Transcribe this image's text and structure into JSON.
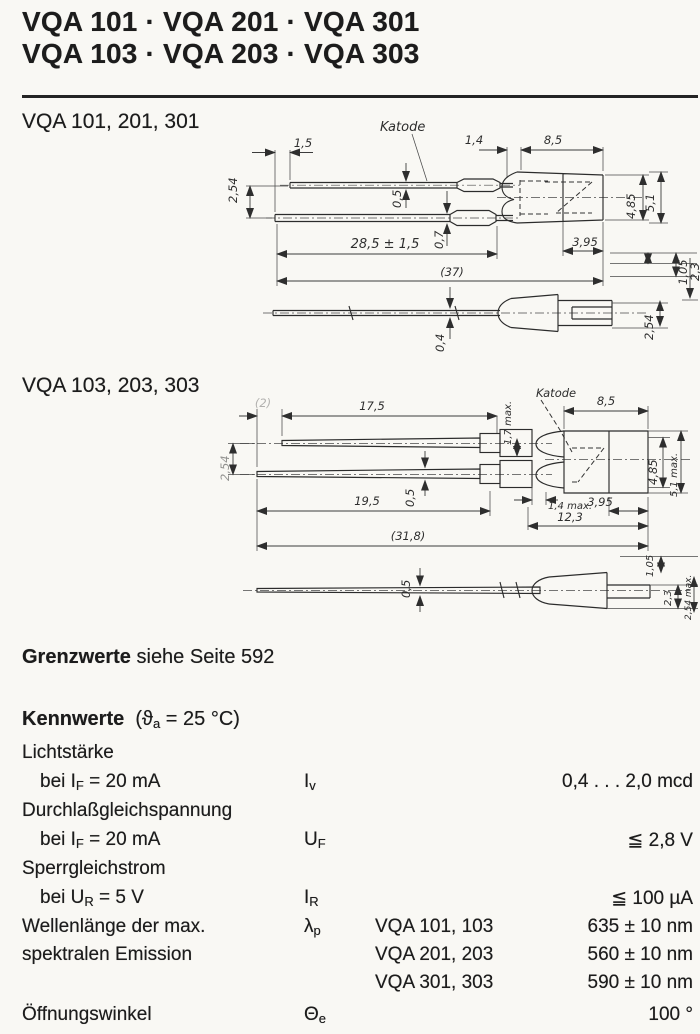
{
  "header": {
    "line1": "VQA 101 · VQA 201 · VQA 301",
    "line2": "VQA 103 · VQA 203 · VQA 303"
  },
  "drawing1": {
    "title": "VQA 101, 201, 301",
    "labels": {
      "katode": "Katode",
      "stagger": "1,5",
      "lead_gap": "2,54",
      "neck": "1,4",
      "body_len": "8,5",
      "lead1_thk": "0,5",
      "lead2_thk": "0,7",
      "lead_len": "28,5 ± 1,5",
      "overall": "(37)",
      "cap_len": "3,95",
      "dia_inner": "4,85",
      "dia_outer": "5,1",
      "off1": "1,05",
      "off2": "2,3",
      "side_lead_thk": "0,4",
      "side_off": "2,54"
    }
  },
  "drawing2": {
    "title": "VQA 103, 203, 303",
    "labels": {
      "katode": "Katode",
      "stagger": "(2)",
      "lead_gap": "2,54",
      "lead1_len": "17,5",
      "crimp": "1,7 max.",
      "body_len": "8,5",
      "lead_thk": "0,5",
      "lead2_len": "19,5",
      "dome": "1,4 max.",
      "cap_len": "3,95",
      "front_len": "12,3",
      "overall": "(31,8)",
      "dia_inner": "4,85",
      "dia_outer": "5,1 max.",
      "side_lead_thk": "0,5",
      "off1": "1,05",
      "off2": "2,3",
      "side_off": "2,54 max."
    }
  },
  "grenzwerte": {
    "bold": "Grenzwerte",
    "rest": " siehe Seite 592"
  },
  "kennwerte": {
    "heading_bold": "Kennwerte",
    "cond_pre": "(ϑ",
    "cond_sub": "a",
    "cond_rest": " = 25 °C)",
    "rows": [
      {
        "label": "Lichtstärke"
      },
      {
        "cond_pre": "bei I",
        "cond_sub": "F",
        "cond_rest": " = 20 mA",
        "sym_base": "I",
        "sym_sub": "v",
        "value": "0,4 . . . 2,0 mcd"
      },
      {
        "label": "Durchlaßgleichspannung"
      },
      {
        "cond_pre": "bei I",
        "cond_sub": "F",
        "cond_rest": " = 20 mA",
        "sym_base": "U",
        "sym_sub": "F",
        "value": "≦ 2,8 V"
      },
      {
        "label": "Sperrgleichstrom"
      },
      {
        "cond_pre": "bei U",
        "cond_sub": "R",
        "cond_rest": " = 5 V",
        "sym_base": "I",
        "sym_sub": "R",
        "value": "≦ 100 µA"
      },
      {
        "label": "Wellenlänge der max.",
        "label2": "spektralen Emission",
        "sym_base": "λ",
        "sym_sub": "p",
        "variants": [
          {
            "types": "VQA 101, 103",
            "value": "635 ± 10 nm"
          },
          {
            "types": "VQA 201, 203",
            "value": "560 ± 10 nm"
          },
          {
            "types": "VQA 301, 303",
            "value": "590 ± 10 nm"
          }
        ]
      },
      {
        "label": "Öffnungswinkel",
        "sym_base": "Θ",
        "sym_sub": "e",
        "value": "100 °"
      }
    ]
  }
}
